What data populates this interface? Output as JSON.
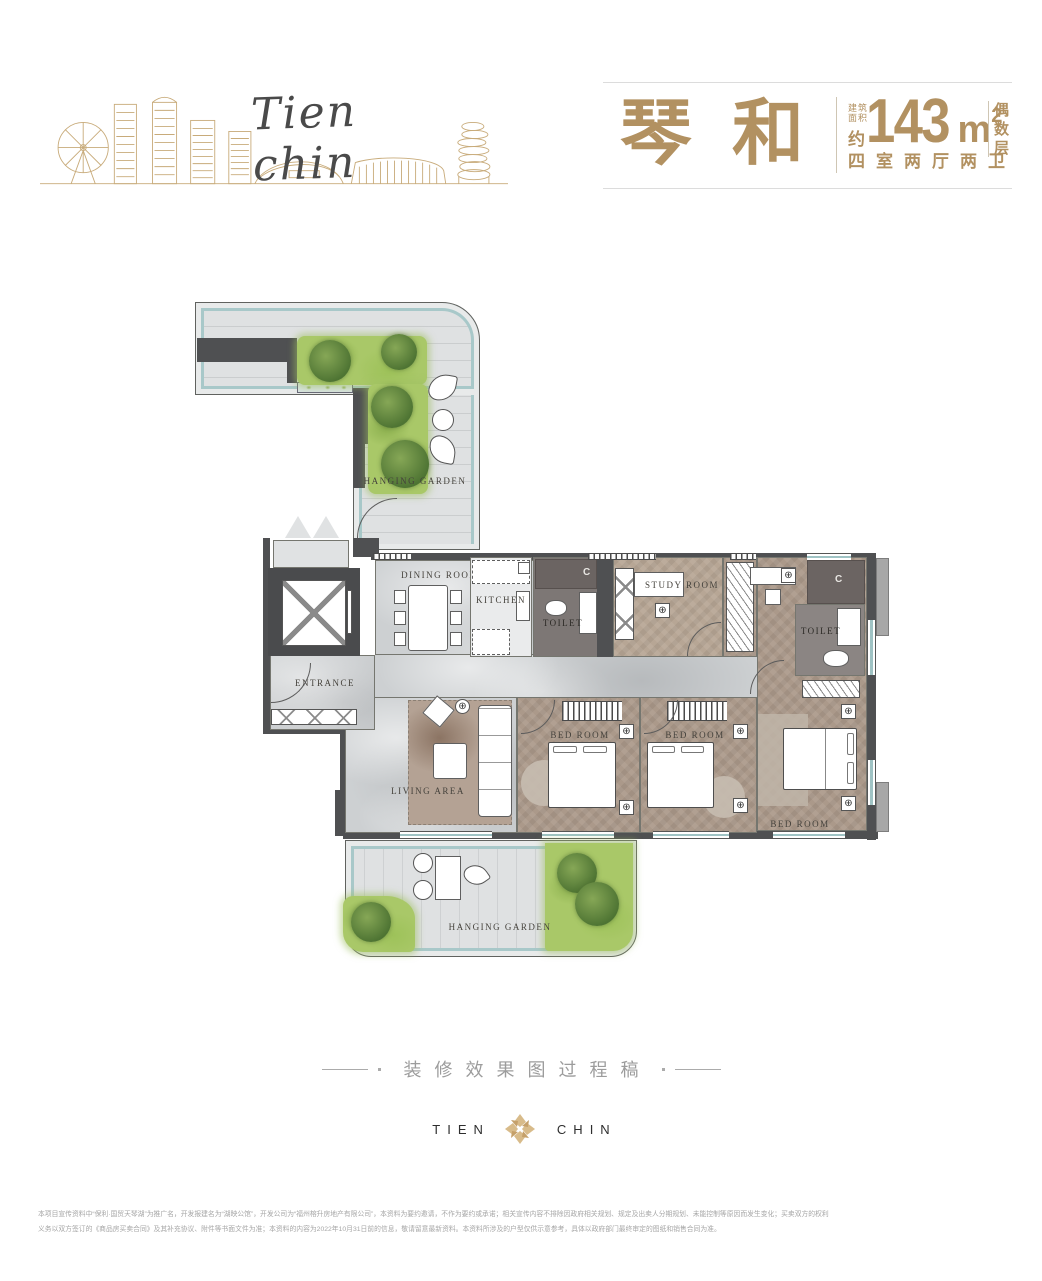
{
  "header": {
    "brand_script": "Tien chin",
    "unit_name": "琴和",
    "area_prefix_line1": "建筑",
    "area_prefix_line2": "面积",
    "area_approx": "约",
    "area_number": "143",
    "area_unit": "m",
    "area_sup": "2",
    "floor_parity": "偶数层",
    "layout_desc": "四室两厅两卫"
  },
  "plan": {
    "rooms": {
      "hanging_garden": "HANGING GARDEN",
      "dining": "DINING ROOM",
      "kitchen": "KITCHEN",
      "toilet": "TOILET",
      "study": "STUDY ROOM",
      "entrance": "ENTRANCE",
      "living": "LIVING AREA",
      "bedroom": "BED ROOM"
    },
    "icons": {
      "fixture_symbol": "⊕",
      "marker_c": "C"
    }
  },
  "footer": {
    "process_note": "装修效果图过程稿",
    "logo_left": "TIEN",
    "logo_right": "CHIN"
  },
  "disclaimer": {
    "line1": "本项目宣传资料中“保利·国贸天琴湖”为推广名，开发报建名为“湖映公馆”，开发公司为“福州榕升房地产有限公司”，本资料为要约邀请，不作为要约或承诺；相关宣传内容不排除因政府相关规划、规定及出卖人分期规划、未能控制等原因而发生变化；买卖双方的权利",
    "line2": "义务以双方签订的《商品房买卖合同》及其补充协议、附件等书面文件为准；本资料的内容为2022年10月31日前的信息，敬请留意最新资料。本资料所涉及的户型仅供示意参考，具体以政府部门最终审定的图纸和销售合同为准。"
  },
  "colors": {
    "gold": "#b29161",
    "teal_rail": "#a8c8c9",
    "lawn_green": "#a9c868",
    "wall_gray": "#4f5052"
  }
}
